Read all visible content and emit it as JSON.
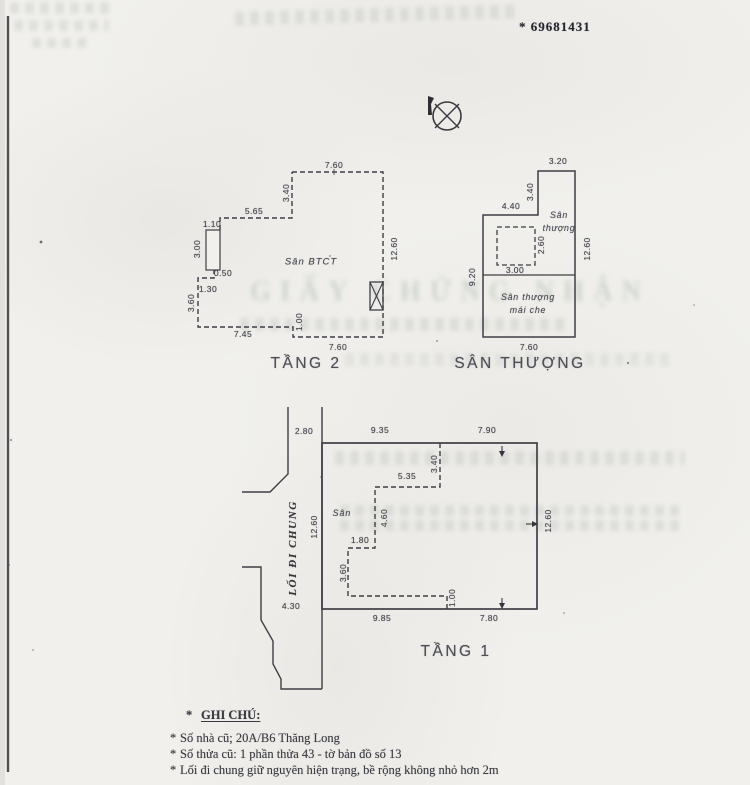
{
  "page": {
    "serial": "* 69681431",
    "bleedthrough_title": "GIẤY CHỨNG NHẬN"
  },
  "plans": {
    "tang2": {
      "title": "TẦNG 2",
      "area_label": "Sân BTCT",
      "dims": {
        "top": "7.60",
        "right": "12.60",
        "bottom_right": "7.60",
        "step": "1.00",
        "bottom_left": "7.45",
        "left": "3.60",
        "ledge": "1.30",
        "offset": "0.50",
        "box_h": "3.00",
        "box_w": "1.10",
        "upper_left": "5.65",
        "upper_v": "3.40"
      }
    },
    "san_thuong": {
      "title": "SÂN THƯỢNG",
      "terrace_line1": "Sân",
      "terrace_line2": "thượng",
      "covered_line1": "Sân thượng",
      "covered_line2": "mái che",
      "dims": {
        "top": "3.20",
        "top_v": "3.40",
        "upper": "4.40",
        "skylight_w": "3.00",
        "skylight_h": "2.60",
        "left": "9.20",
        "right": "12.60",
        "bottom": "7.60"
      }
    },
    "tang1": {
      "title": "TẦNG 1",
      "area_label": "Sân",
      "passage_label": "LỐI ĐI CHUNG",
      "dims": {
        "passage_top": "2.80",
        "top_left": "9.35",
        "top_right": "7.90",
        "left": "12.60",
        "right": "12.60",
        "passage_bottom": "4.30",
        "inner_v1": "3.40",
        "inner_h1": "5.35",
        "inner_v2": "4.60",
        "inner_h2": "1.80",
        "inner_v3": "3.60",
        "inner_v4": "1.00",
        "bottom_left": "9.85",
        "bottom_right": "7.80"
      }
    }
  },
  "notes": {
    "star": "*",
    "heading": "GHI CHÚ:",
    "items": [
      "Số nhà cũ; 20A/B6 Thăng Long",
      "Số thửa cũ: 1 phần thửa 43 - tờ bản đồ số 13",
      "Lối đi chung giữ nguyên hiện trạng, bề rộng không nhỏ hơn 2m"
    ]
  }
}
